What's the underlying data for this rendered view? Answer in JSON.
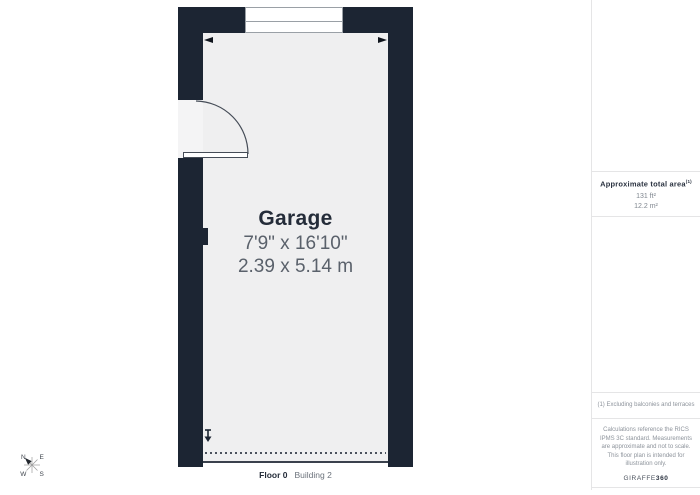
{
  "plan": {
    "room_name": "Garage",
    "dimensions_imperial": "7'9\" x 16'10\"",
    "dimensions_metric": "2.39 x 5.14 m",
    "floor_label": "Floor 0",
    "building_label": "Building 2"
  },
  "sidebar": {
    "area_title": "Approximate total area",
    "area_title_sup": "(1)",
    "area_imperial": "131 ft²",
    "area_metric": "12.2 m²",
    "footnote": "(1) Excluding balconies and terraces",
    "disclaimer": "Calculations reference the RICS IPMS 3C standard. Measurements are approximate and not to scale. This floor plan is intended for illustration only.",
    "brand_regular": "GIRAFFE",
    "brand_bold": "360"
  },
  "compass": {
    "n": "N",
    "e": "E",
    "w": "W",
    "s": "S"
  },
  "colors": {
    "wall": "#1c2533",
    "floor": "#efeff0",
    "text_dark": "#242c39",
    "text_gray": "#5a616b",
    "muted": "#8d939b",
    "border": "#e5e5e6"
  }
}
